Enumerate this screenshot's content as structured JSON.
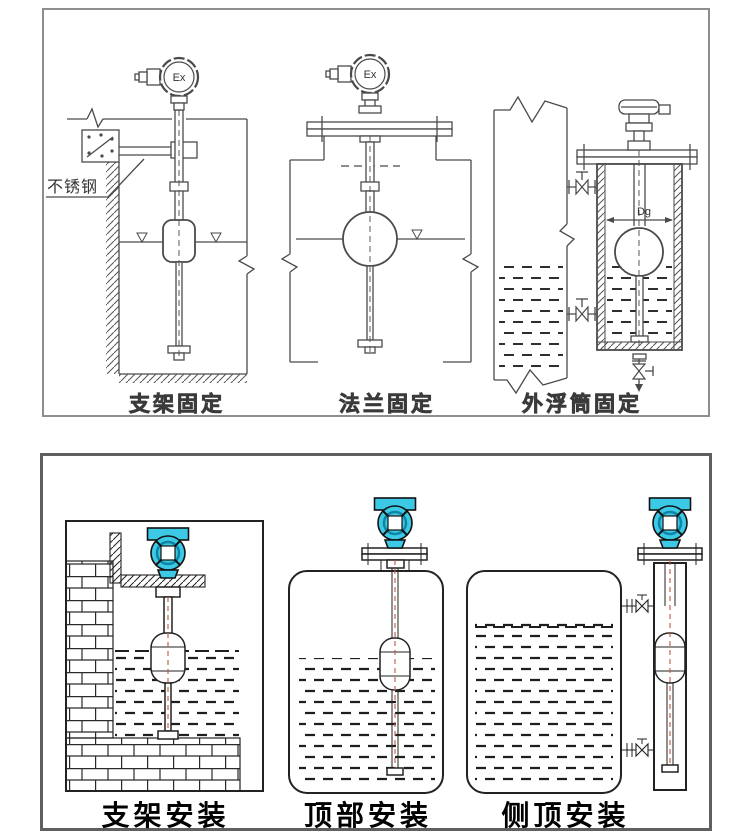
{
  "colors": {
    "line_top": "#4a4a4a",
    "line_bottom": "#222222",
    "transmitter_cyan": "#3cc9e6",
    "transmitter_ring": "#0e85a5",
    "centerline_red": "#b85a45",
    "top_panel_border": "#8e8e8e",
    "bottom_panel_border": "#5f5f5f"
  },
  "top_panel": {
    "diagrams": [
      {
        "id": "bracket-fixing",
        "caption": "支架固定",
        "head_label": "Ex",
        "annotation": "不锈钢"
      },
      {
        "id": "flange-fixing",
        "caption": "法兰固定",
        "head_label": "Ex"
      },
      {
        "id": "external-chamber-fixing",
        "caption": "外浮筒固定",
        "dimension_label": "Dg"
      }
    ]
  },
  "bottom_panel": {
    "diagrams": [
      {
        "id": "bracket-mounting",
        "caption": "支架安装"
      },
      {
        "id": "top-mounting",
        "caption": "顶部安装"
      },
      {
        "id": "side-top-mounting",
        "caption": "侧顶安装"
      }
    ]
  }
}
